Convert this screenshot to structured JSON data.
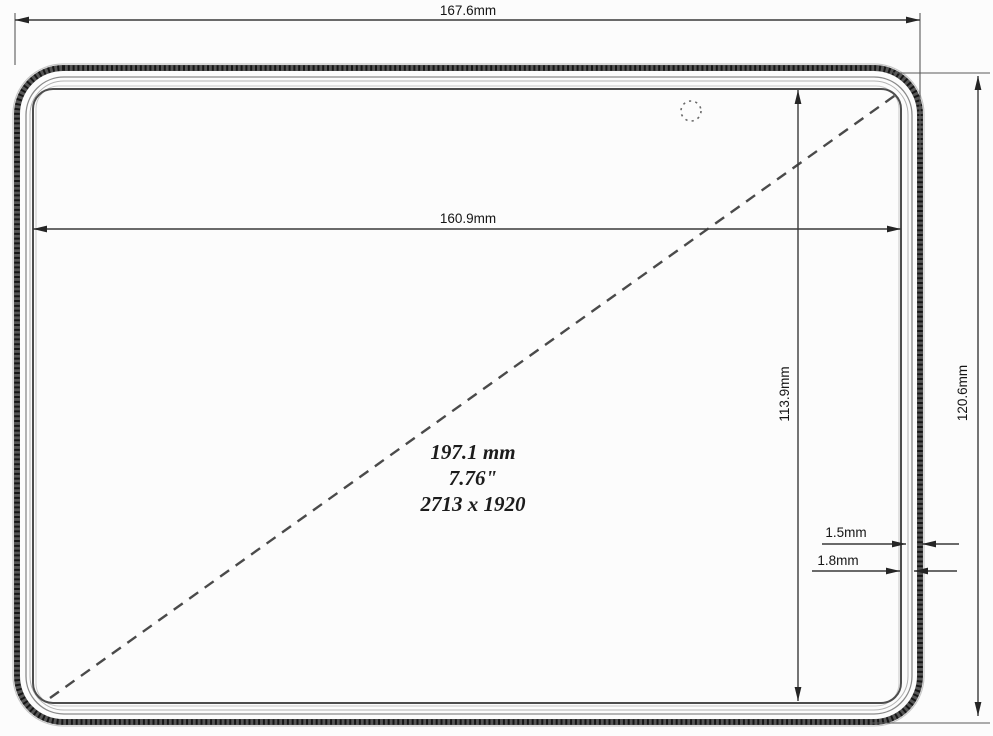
{
  "drawing": {
    "kind": "tablet-front-dimension-drawing",
    "labels": {
      "overall_width": "167.6mm",
      "display_width": "160.9mm",
      "display_height": "113.9mm",
      "overall_height": "120.6mm",
      "bezel_inner": "1.5mm",
      "bezel_outer": "1.8mm"
    },
    "display_info": {
      "diagonal_mm": "197.1 mm",
      "diagonal_inch": "7.76\"",
      "resolution": "2713 x 1920"
    },
    "colors": {
      "background": "#fcfcfc",
      "line": "#3a3a3a",
      "text": "#151515"
    }
  }
}
